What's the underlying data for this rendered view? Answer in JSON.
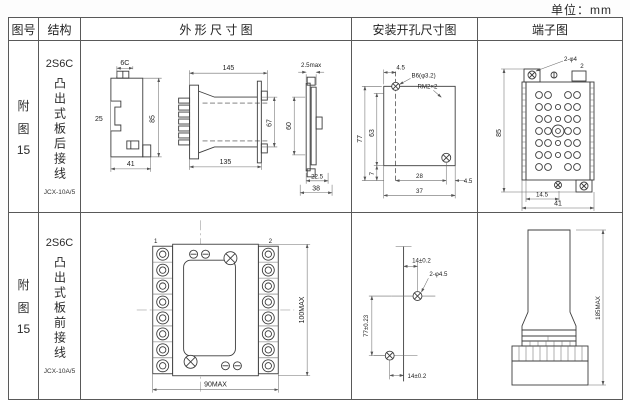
{
  "unit": "单位：mm",
  "header": {
    "fig": "图号",
    "structure": "结构",
    "outline": "外 形 尺 寸 图",
    "mounting": "安装开孔尺寸图",
    "terminal": "端子图"
  },
  "rows": [
    {
      "fig_no": [
        "附",
        "图",
        "15"
      ],
      "structure": {
        "model": "2S6C",
        "desc": "凸出式板后接线",
        "sub": "JCX-10A/5"
      },
      "outline": {
        "viewA": {
          "top": "6C",
          "left": "25",
          "right": "85",
          "bottom": "41"
        },
        "viewB": {
          "top": "145",
          "bottom": "135",
          "right": "67"
        },
        "viewC": {
          "top": "2.5max",
          "left": "60",
          "inner": "22.5",
          "bottom": "38"
        }
      },
      "mounting": {
        "top": "4.5",
        "hole_label": "B6(φ3.2)",
        "thread_label": "RM2×2",
        "left_outer": "77",
        "left_inner": "63",
        "left_small": "7",
        "bottom_inner": "28",
        "right_offset": "4.5",
        "bottom": "37"
      },
      "terminal": {
        "hole_label": "2-φ4",
        "left": "85",
        "inner": "14.5",
        "bottom": "41",
        "corner": "2"
      }
    },
    {
      "fig_no": [
        "附",
        "图",
        "15"
      ],
      "structure": {
        "model": "2S6C",
        "desc": "凸出式板前接线",
        "sub": "JCX-10A/5"
      },
      "outline": {
        "bottom": "90MAX",
        "right": "100MAX",
        "corner_left": "1",
        "corner_right": "2"
      },
      "mounting": {
        "top": "14±0.2",
        "hole_label": "2-φ4.5",
        "left": "77±0.23",
        "bottom": "14±0.2"
      },
      "terminal": {
        "right": "185MAX"
      }
    }
  ]
}
